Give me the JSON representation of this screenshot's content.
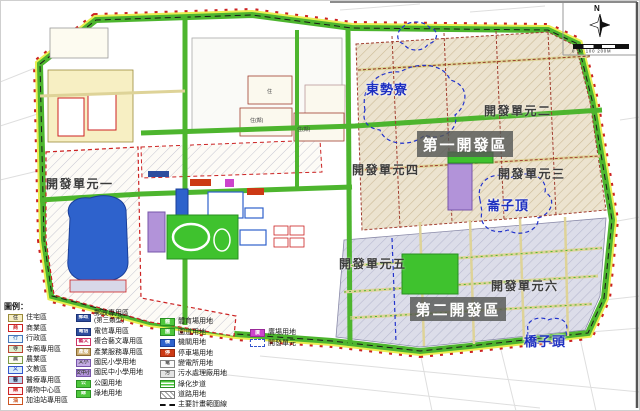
{
  "compass": {
    "north_label": "N",
    "scale_text": "0 50 100   200M"
  },
  "legend": {
    "title": "圖例：",
    "columns": [
      [
        {
          "label": "住宅區",
          "fill": "#f7efc3",
          "border": "#9a8b3a",
          "code": "住",
          "codeColor": "#555"
        },
        {
          "label": "商業區",
          "fill": "#ffffff",
          "border": "#cc2222",
          "code": "商",
          "codeColor": "#cc2222"
        },
        {
          "label": "行政區",
          "fill": "#eaf6fa",
          "border": "#4477bb",
          "code": "行",
          "codeColor": "#4477bb"
        },
        {
          "label": "寺廟專用區",
          "fill": "#dff0d0",
          "border": "#bb4433",
          "code": "寺",
          "codeColor": "#555"
        },
        {
          "label": "農業區",
          "fill": "#fbfbef",
          "border": "#7a9a44",
          "code": "農",
          "codeColor": "#555"
        },
        {
          "label": "文教區",
          "fill": "#d9ecfa",
          "border": "#3355cc",
          "code": "文",
          "codeColor": "#3355cc"
        },
        {
          "label": "醫療專用區",
          "fill": "#bcd6ef",
          "border": "#aa3344",
          "code": "醫",
          "codeColor": "#333355"
        },
        {
          "label": "購物中心區",
          "fill": "#ffeef0",
          "border": "#cc2222",
          "code": "購",
          "codeColor": "#cc2222"
        },
        {
          "label": "加油站專用區",
          "fill": "#ffffff",
          "border": "#cc5522",
          "code": "油",
          "codeColor": "#cc5522"
        }
      ],
      [
        {
          "label": "郵政專用區",
          "label2": "(第三類型)",
          "fill": "#2e4d9e",
          "border": "#1c3377",
          "code": "郵政",
          "codeColor": "#ffffff"
        },
        {
          "label": "電信專用區",
          "fill": "#2e4d9e",
          "border": "#1c3377",
          "code": "電信",
          "codeColor": "#ffffff"
        },
        {
          "label": "複合藝文專用區",
          "fill": "#ffffff",
          "border": "#cc3366",
          "code": "藝文",
          "codeColor": "#cc3366"
        },
        {
          "label": "產業服務專用區",
          "fill": "#c9a86b",
          "border": "#8a6a33",
          "code": "產服",
          "codeColor": "#ffffff"
        },
        {
          "label": "國民小學用地",
          "fill": "#c3abe3",
          "border": "#7755aa",
          "code": "文小",
          "codeColor": "#444444"
        },
        {
          "label": "國民中小學用地",
          "fill": "#b293d9",
          "border": "#7755aa",
          "code": "文中小",
          "codeColor": "#444444"
        },
        {
          "label": "公園用地",
          "fill": "#4ec73c",
          "border": "#2a8f22",
          "code": "公",
          "codeColor": "#ffffff"
        },
        {
          "label": "綠地用地",
          "fill": "#4ec73c",
          "border": "#2a8f22",
          "code": "綠",
          "codeColor": "#ffffff"
        }
      ],
      [
        {
          "label": "體育場用地",
          "fill": "#4ec73c",
          "border": "#2a8f22",
          "code": "體",
          "codeColor": "#ffffff"
        },
        {
          "label": "園道用地",
          "fill": "#4ec73c",
          "border": "#2a8f22",
          "code": "園",
          "codeColor": "#ffffff"
        },
        {
          "label": "機關用地",
          "fill": "#2e62cc",
          "border": "#1a3f99",
          "code": "機",
          "codeColor": "#ffffff"
        },
        {
          "label": "停車場用地",
          "fill": "#cc3914",
          "border": "#992a0f",
          "code": "停",
          "codeColor": "#ffffff"
        },
        {
          "label": "變電所用地",
          "fill": "#fbfbfb",
          "border": "#888888",
          "code": "電",
          "codeColor": "#555555"
        },
        {
          "label": "污水處理廠用地",
          "fill": "#e4e4e4",
          "border": "#888888",
          "code": "污",
          "codeColor": "#555555"
        },
        {
          "label": "綠化步道",
          "kind": "stripes"
        },
        {
          "label": "道路用地",
          "kind": "hatch"
        },
        {
          "label": "主要計畫範圍線",
          "kind": "dashline"
        }
      ],
      [
        {
          "label": "廣場用地",
          "fill": "#cc44cc",
          "border": "#992a99",
          "code": "廣",
          "codeColor": "#ffffff"
        },
        {
          "label": "開發單元",
          "kind": "dashedbox"
        }
      ]
    ]
  },
  "map": {
    "unit_labels": [
      {
        "text": "開發單元一",
        "x": 46,
        "y": 175
      },
      {
        "text": "開發單元二",
        "x": 484,
        "y": 102
      },
      {
        "text": "開發單元三",
        "x": 498,
        "y": 165
      },
      {
        "text": "開發單元四",
        "x": 352,
        "y": 161
      },
      {
        "text": "開發單元五",
        "x": 339,
        "y": 255
      },
      {
        "text": "開發單元六",
        "x": 491,
        "y": 277
      }
    ],
    "area_labels": [
      {
        "text": "第一開發區",
        "x": 417,
        "y": 131,
        "w": 96,
        "h": 26
      },
      {
        "text": "第二開發區",
        "x": 410,
        "y": 297,
        "w": 96,
        "h": 24
      }
    ],
    "settlement_labels": [
      {
        "text": "東勢寮",
        "x": 366,
        "y": 79
      },
      {
        "text": "崙子頂",
        "x": 487,
        "y": 195
      },
      {
        "text": "橋子頭",
        "x": 524,
        "y": 331
      }
    ],
    "parcel_labels": [
      {
        "text": "住(鄰)",
        "x": 250,
        "y": 117
      },
      {
        "text": "住(鄰)",
        "x": 297,
        "y": 126
      },
      {
        "text": "住",
        "x": 267,
        "y": 88
      }
    ]
  },
  "colors": {
    "boundary_green": "#4db52e",
    "boundary_yellow": "#e8ef52",
    "plan_red_dash": "#cc2222",
    "dev1_fill": "#ece3cf",
    "dev2_fill": "#dcdde9",
    "park_green": "#3fc22e",
    "institution_blue": "#2e62cc",
    "school_purple": "#b293d9",
    "parking_red": "#cc3914",
    "plaza_magenta": "#cc44cc",
    "postal_blue": "#2e4d9e",
    "settlement_blue": "#2233cc"
  }
}
